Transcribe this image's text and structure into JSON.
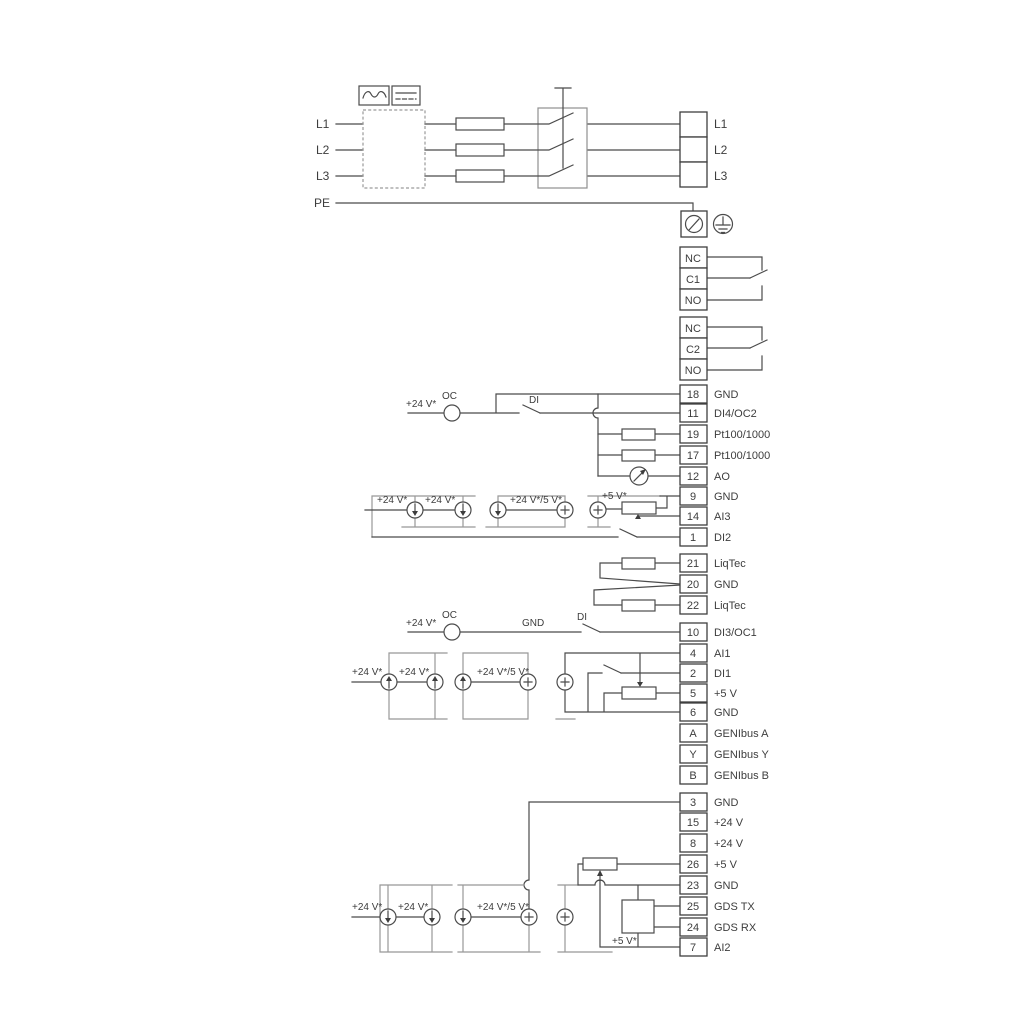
{
  "colors": {
    "wire": "#4b4b4b",
    "rail_gray": "#989898",
    "text": "#3d3d3d",
    "background": "#ffffff"
  },
  "power_input": {
    "l1": "L1",
    "l2": "L2",
    "l3": "L3",
    "pe": "PE"
  },
  "power_output": {
    "l1": "L1",
    "l2": "L2",
    "l3": "L3"
  },
  "relay1": {
    "nc": "NC",
    "c": "C1",
    "no": "NO"
  },
  "relay2": {
    "nc": "NC",
    "c": "C2",
    "no": "NO"
  },
  "strip_io": [
    {
      "num": "18",
      "label": "GND"
    },
    {
      "num": "11",
      "label": "DI4/OC2"
    },
    {
      "num": "19",
      "label": "Pt100/1000"
    },
    {
      "num": "17",
      "label": "Pt100/1000"
    },
    {
      "num": "12",
      "label": "AO"
    },
    {
      "num": "9",
      "label": "GND"
    },
    {
      "num": "14",
      "label": "AI3"
    },
    {
      "num": "1",
      "label": "DI2"
    }
  ],
  "strip_liqtec": [
    {
      "num": "21",
      "label": "LiqTec"
    },
    {
      "num": "20",
      "label": "GND"
    },
    {
      "num": "22",
      "label": "LiqTec"
    }
  ],
  "strip_di3": {
    "num": "10",
    "label": "DI3/OC1"
  },
  "strip_comm": [
    {
      "num": "4",
      "label": "AI1"
    },
    {
      "num": "2",
      "label": "DI1"
    },
    {
      "num": "5",
      "label": "+5 V"
    },
    {
      "num": "6",
      "label": "GND"
    },
    {
      "num": "A",
      "label": "GENIbus A"
    },
    {
      "num": "Y",
      "label": "GENIbus Y"
    },
    {
      "num": "B",
      "label": "GENIbus B"
    }
  ],
  "strip_bottom": [
    {
      "num": "3",
      "label": "GND"
    },
    {
      "num": "15",
      "label": "+24 V"
    },
    {
      "num": "8",
      "label": "+24 V"
    },
    {
      "num": "26",
      "label": "+5 V"
    },
    {
      "num": "23",
      "label": "GND"
    },
    {
      "num": "25",
      "label": "GDS TX"
    },
    {
      "num": "24",
      "label": "GDS RX"
    },
    {
      "num": "7",
      "label": "AI2"
    }
  ],
  "annotations": {
    "v24": "+24 V*",
    "v24_5": "+24 V*/5 V*",
    "v5": "+5 V*",
    "oc": "OC",
    "di": "DI",
    "gnd": "GND"
  }
}
